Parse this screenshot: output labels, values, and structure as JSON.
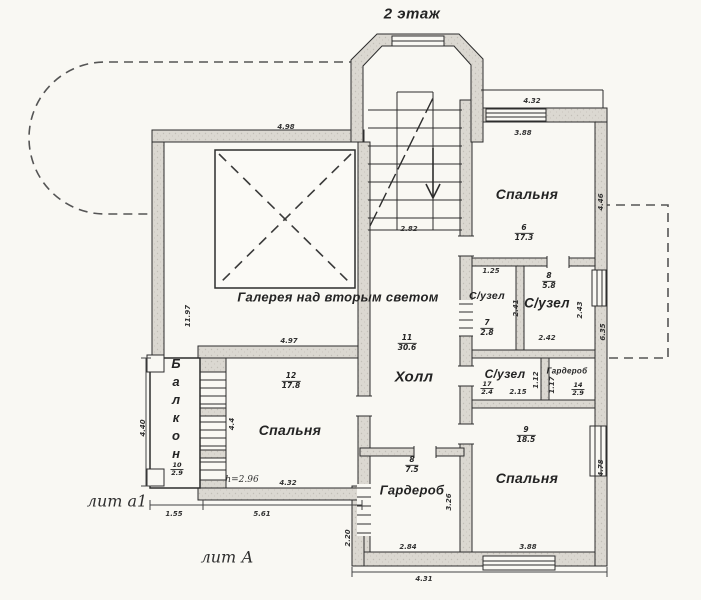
{
  "title": "2 этаж",
  "marks": {
    "lit_a1": "лит а1",
    "lit_A": "лит А"
  },
  "notes": {
    "ceiling_height": "h=2.96"
  },
  "colors": {
    "paper": "#f9f8f3",
    "ink": "#2d2d2d",
    "wall_fill": "#dbd8d1",
    "dash": "#555555"
  },
  "rooms": {
    "gallery": {
      "label": "Галерея над вторым светом"
    },
    "hall": {
      "label": "Холл",
      "number": "11",
      "area": "30.6"
    },
    "bedroom_ne": {
      "label": "Спальня",
      "number": "6",
      "area": "17.3"
    },
    "bathroom_upper_left": {
      "label": "С/узел",
      "number": "7",
      "area": "2.8"
    },
    "bathroom_upper_right": {
      "label": "С/узел",
      "number": "8",
      "area": "5.8"
    },
    "bathroom_mid": {
      "label": "С/узел",
      "number": "17",
      "area": "2.4"
    },
    "wardrobe_small": {
      "label": "Гардероб",
      "number": "14",
      "area": "2.9"
    },
    "bedroom_se": {
      "label": "Спальня",
      "number": "9",
      "area": "18.5"
    },
    "wardrobe_bottom": {
      "label": "Гардероб",
      "number": "8",
      "area": "7.5"
    },
    "bedroom_w": {
      "label": "Спальня",
      "number": "12",
      "area": "17.8"
    },
    "balcony": {
      "label": "Балкон",
      "number": "10",
      "area": "2.9"
    }
  },
  "dims": {
    "stair_width": "2.82",
    "gallery_top": "4.98",
    "gallery_wall": "4.97",
    "ne_top_outer": "4.32",
    "ne_top_inner": "3.88",
    "ne_right": "4.46",
    "east_mid": "6.35",
    "west_wall": "11.97",
    "bath_small_top": "1.25",
    "bath_small_side": "2.41",
    "bath_large_bottom": "2.42",
    "bath_large_side": "2.43",
    "bath_mid_bottom": "2.15",
    "bath_mid_side": "1.12",
    "wardrobe_small_side": "1.17",
    "se_right": "4.78",
    "se_bottom": "3.88",
    "bottom_right_outer": "4.31",
    "wardrobe_bottom_width": "2.84",
    "wardrobe_bottom_side": "3.26",
    "bottom_step_side": "2.20",
    "w_bedroom_bottom": "4.32",
    "w_bedroom_side": "4.4",
    "bottom_left_outer": "5.61",
    "balcony_bottom": "1.55",
    "balcony_side": "4.40"
  }
}
